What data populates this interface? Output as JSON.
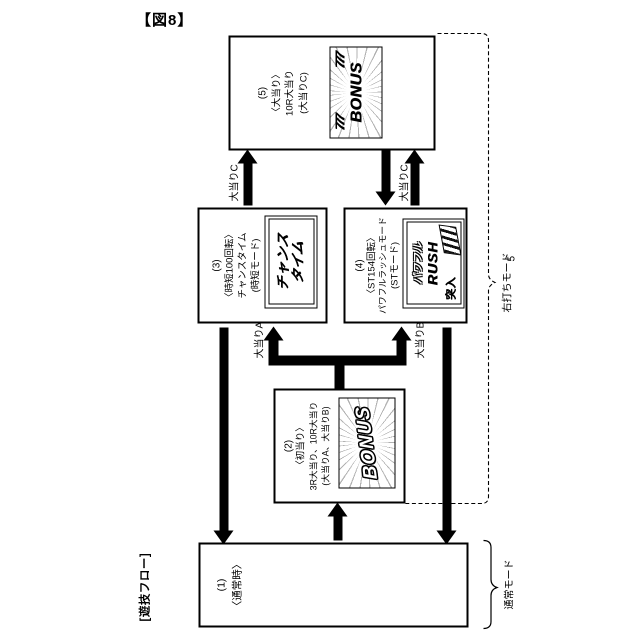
{
  "figure_label": "【図8】",
  "flow_label": "[遊技フロー]",
  "ref_numeral": "5",
  "modes": {
    "right_strike": "右打ちモード",
    "normal": "通常モード"
  },
  "arrow_labels": {
    "a": "大当りA",
    "b": "大当りB",
    "c_left": "大当りC",
    "c_right": "大当りC"
  },
  "boxes": {
    "b1": {
      "number": "(1)",
      "lines": [
        "〈通常時〉"
      ]
    },
    "b2": {
      "number": "(2)",
      "lines": [
        "〈初当り〉",
        "3R大当り、10R大当り",
        "(大当りA、大当りB)"
      ],
      "screen": {
        "title": "BONUS"
      }
    },
    "b3": {
      "number": "(3)",
      "lines": [
        "〈時短100回転〉",
        "チャンスタイム",
        "(時短モード)"
      ],
      "screen": {
        "line1": "チャンス",
        "line2": "タイム"
      }
    },
    "b4": {
      "number": "(4)",
      "lines": [
        "〈ST154回転〉",
        "パワフルラッシュモード",
        "(STモード)"
      ],
      "screen": {
        "line1": "パワフル",
        "line2": "RUSH",
        "line3": "突入"
      }
    },
    "b5": {
      "number": "(5)",
      "lines": [
        "〈大当り〉",
        "10R大当り",
        "(大当りC)"
      ],
      "screen": {
        "sevens": "777",
        "title": "BONUS"
      }
    }
  },
  "colors": {
    "ink": "#000000",
    "paper": "#ffffff"
  }
}
